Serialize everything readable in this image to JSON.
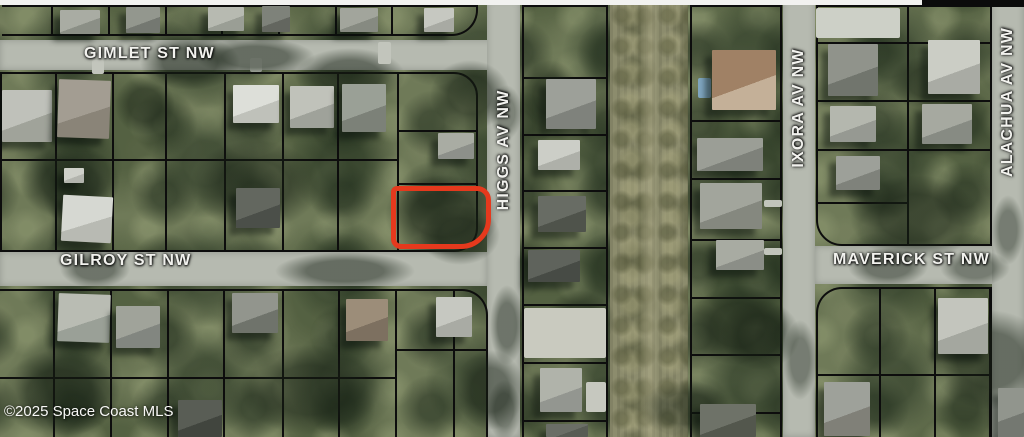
{
  "map": {
    "attribution": "©2025 Space Coast MLS",
    "provider": "Space Coast MLS",
    "year": "2025",
    "imagery": "aerial-satellite",
    "streets": [
      {
        "id": "gimlet",
        "name": "GIMLET ST NW",
        "orientation": "horizontal",
        "road": {
          "x": 0,
          "y": 40,
          "w": 496,
          "h": 30
        },
        "label": {
          "x": 84,
          "y": 45
        }
      },
      {
        "id": "gilroy",
        "name": "GILROY ST NW",
        "orientation": "horizontal",
        "road": {
          "x": 0,
          "y": 252,
          "w": 487,
          "h": 34
        },
        "label": {
          "x": 60,
          "y": 252
        }
      },
      {
        "id": "maverick",
        "name": "MAVERICK ST NW",
        "orientation": "horizontal",
        "road": {
          "x": 815,
          "y": 246,
          "w": 209,
          "h": 38
        },
        "label": {
          "x": 833,
          "y": 251
        }
      },
      {
        "id": "higgs",
        "name": "HIGGS AV NW",
        "orientation": "vertical",
        "road": {
          "x": 487,
          "y": 0,
          "w": 33,
          "h": 437
        },
        "label": {
          "x": 504,
          "y": 150
        }
      },
      {
        "id": "ixora",
        "name": "IXORA AV NW",
        "orientation": "vertical",
        "road": {
          "x": 783,
          "y": 0,
          "w": 32,
          "h": 437
        },
        "label": {
          "x": 799,
          "y": 108
        }
      },
      {
        "id": "alachua",
        "name": "ALACHUA AV NW",
        "orientation": "vertical",
        "road": {
          "x": 992,
          "y": 0,
          "w": 32,
          "h": 437
        },
        "label": {
          "x": 1008,
          "y": 102
        }
      }
    ],
    "highlighted_parcel": {
      "x": 391,
      "y": 186,
      "w": 100,
      "h": 63,
      "stroke_width": 5,
      "color": "#e5391d",
      "corner_radius": "6px 14px 30px 10px"
    },
    "colors": {
      "vegetation": "#6f7a58",
      "road": "#b6bab0",
      "parcel_line": "#0d0d0d",
      "corridor": "#8c8c6d",
      "label_text": "#f2f2ee",
      "top_strip_white": "#f2f2f0",
      "top_strip_black": "#0b0b0b"
    }
  }
}
